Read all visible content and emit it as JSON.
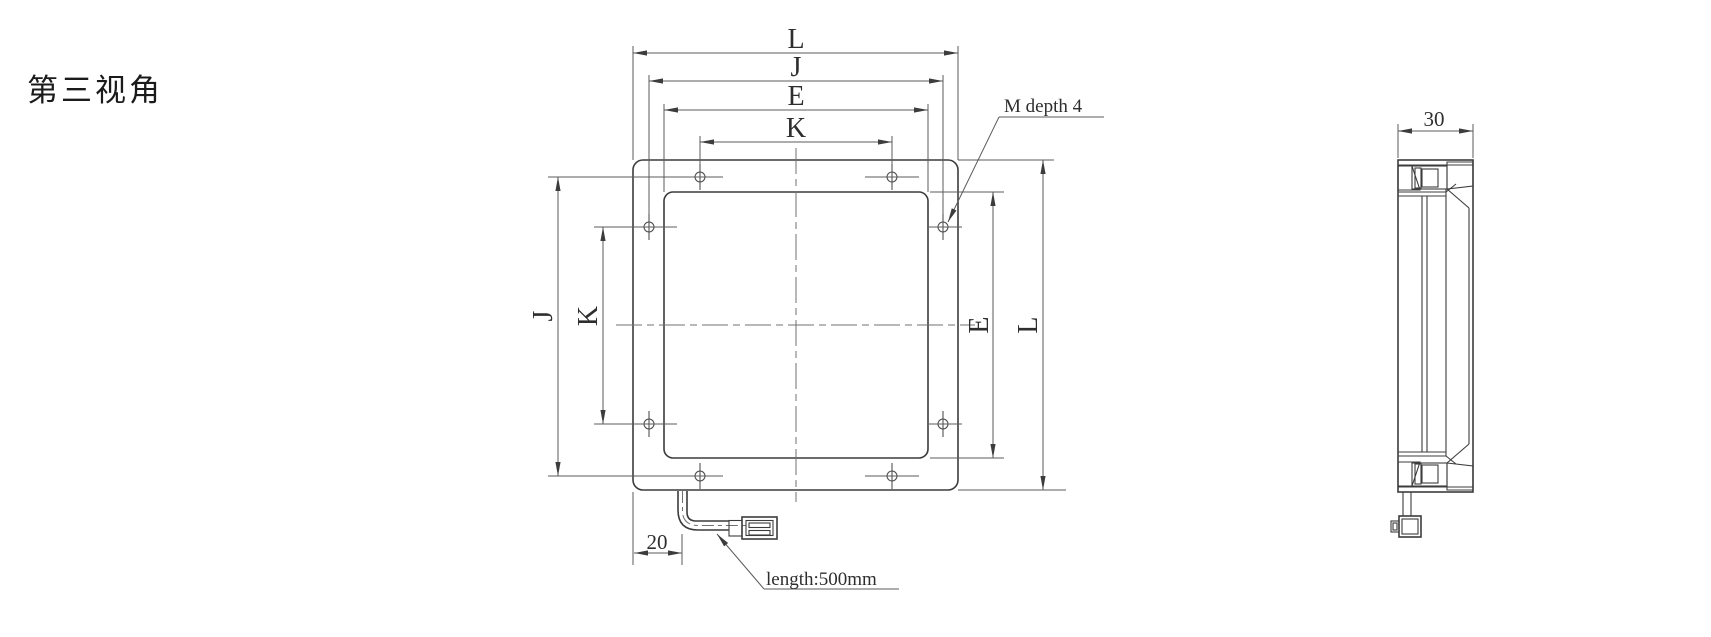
{
  "title": "第三视角",
  "front_view": {
    "horizontal_dims": {
      "outer_width": "L",
      "hole_pitch_outer": "J",
      "window_width": "E",
      "hole_pitch_inner": "K"
    },
    "vertical_dims": {
      "hole_pitch_outer": "J",
      "hole_pitch_inner": "K",
      "window_height": "E",
      "outer_height": "L"
    },
    "annotations": {
      "thread_callout": "M depth 4",
      "cable_offset": "20",
      "cable_length": "length:500mm"
    }
  },
  "side_view": {
    "thickness_dim": "30"
  }
}
